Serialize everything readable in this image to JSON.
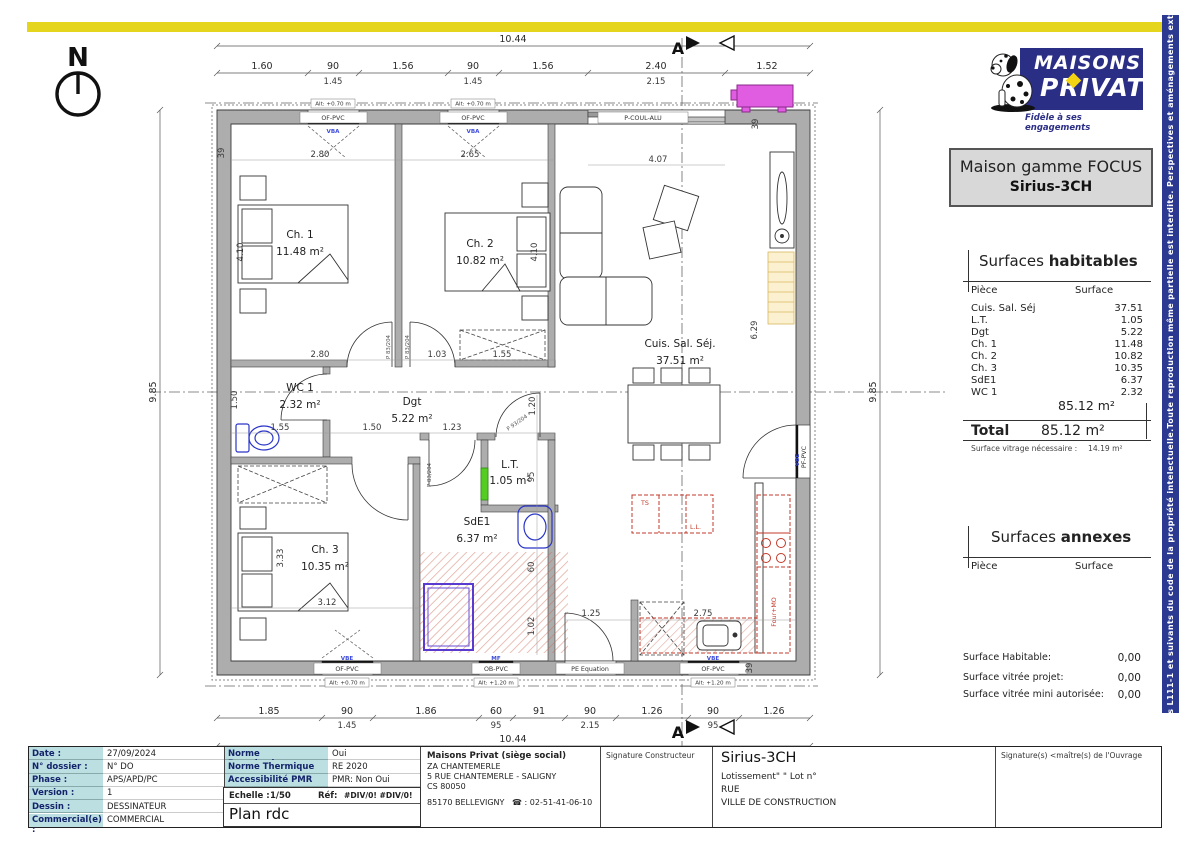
{
  "colors": {
    "brand_blue": "#2b2e85",
    "accent_yellow": "#e6d51d",
    "label_teal": "#bcdfe2",
    "wall_gray": "#adadad",
    "kitchen_red": "#c0392b",
    "pac_magenta": "#e05ce0",
    "sanitary_blue": "#2a35c8",
    "shower_purple": "#5a3bd0",
    "heater_green": "#55cc22"
  },
  "logo": {
    "line1": "MAISONS",
    "line2": "PRIVAT",
    "tagline": "Fidèle à ses engagements"
  },
  "model_box": {
    "line1": "Maison gamme FOCUS",
    "line2": "Sirius-3CH"
  },
  "surfaces_habitables": {
    "title_normal": "Surfaces ",
    "title_bold": "habitables",
    "col_piece": "Pièce",
    "col_surface": "Surface",
    "rows": [
      {
        "piece": "Cuis. Sal. Séj",
        "surface": "37.51"
      },
      {
        "piece": "L.T.",
        "surface": "1.05"
      },
      {
        "piece": "Dgt",
        "surface": "5.22"
      },
      {
        "piece": "Ch. 1",
        "surface": "11.48"
      },
      {
        "piece": "Ch. 2",
        "surface": "10.82"
      },
      {
        "piece": "Ch. 3",
        "surface": "10.35"
      },
      {
        "piece": "SdE1",
        "surface": "6.37"
      },
      {
        "piece": "WC 1",
        "surface": "2.32"
      }
    ],
    "subtotal": "85.12 m²",
    "total_label": "Total",
    "total_value": "85.12 m²",
    "note_label": "Surface vitrage nécessaire :",
    "note_value": "14.19 m²"
  },
  "surfaces_annexes": {
    "title_normal": "Surfaces ",
    "title_bold": "annexes",
    "col_piece": "Pièce",
    "col_surface": "Surface"
  },
  "summary": {
    "rows": [
      {
        "label": "Surface Habitable:",
        "value": "0,00"
      },
      {
        "label": "Surface vitrée projet:",
        "value": "0,00"
      },
      {
        "label": "Surface vitrée mini autorisée:",
        "value": "0,00"
      }
    ]
  },
  "side_strip": {
    "text": "Plans protégés par les articles L111-1 et suivants du code de la propriété intelectuelle.Toute reproduction même partielle est interdite. Perspectives et aménagements extérieurs sont non contractuels"
  },
  "title_block": {
    "info_rows": [
      {
        "label": "Date :",
        "value": "27/09/2024"
      },
      {
        "label": "N° dossier :",
        "value": "N° DO"
      },
      {
        "label": "Phase :",
        "value": "APS/APD/PC"
      },
      {
        "label": "Version :",
        "value": "1"
      },
      {
        "label": "Dessin :",
        "value": "DESSINATEUR"
      },
      {
        "label": "Commercial(e) :",
        "value": "COMMERCIAL"
      }
    ],
    "norm_rows": [
      {
        "label": "Norme Parasismique",
        "value": "Oui"
      },
      {
        "label": "Norme Thermique",
        "value": "RE 2020"
      },
      {
        "label": "Accessibilité PMR",
        "value": "PMR: Non Oui"
      }
    ],
    "echelle_label": "Echelle :",
    "echelle_value": "1/50",
    "ref_label": "Réf:",
    "ref_value": "#DIV/0! #DIV/0!",
    "plan_name": "Plan rdc",
    "company": {
      "name": "Maisons Privat (siège social)",
      "line1": "ZA CHANTEMERLE",
      "line2": "5 RUE CHANTEMERLE - SALIGNY",
      "line3": "CS 80050",
      "line4": "85170 BELLEVIGNY",
      "phone": "☎ : 02-51-41-06-10"
    },
    "sig_constructor": "Signature Constructeur",
    "project": {
      "name": "Sirius-3CH",
      "line1": "Lotissement\"  \" Lot n°",
      "line2": "RUE",
      "line3": "VILLE DE CONSTRUCTION"
    },
    "sig_owner": "Signature(s) <maître(s) de l'Ouvrage"
  },
  "plan": {
    "north_label": "N",
    "section_label": "A",
    "overall_width": "10.44",
    "overall_height": "9.85",
    "top_chain": [
      "1.60",
      "90",
      "1.56",
      "90",
      "1.56",
      "2.40",
      "1.52"
    ],
    "top_chain_sub": [
      "1.45",
      "1.45",
      "2.15"
    ],
    "bottom_chain": [
      "1.85",
      "90",
      "1.86",
      "60",
      "91",
      "90",
      "1.26",
      "90",
      "1.26"
    ],
    "bottom_chain_sub": [
      "1.45",
      "95",
      "2.15",
      "95"
    ],
    "rooms": [
      {
        "name": "Ch. 1",
        "area": "11.48 m²"
      },
      {
        "name": "Ch. 2",
        "area": "10.82 m²"
      },
      {
        "name": "Cuis. Sal. Séj.",
        "area": "37.51 m²"
      },
      {
        "name": "WC 1",
        "area": "2.32 m²"
      },
      {
        "name": "Dgt",
        "area": "5.22 m²"
      },
      {
        "name": "L.T.",
        "area": "1.05 m²"
      },
      {
        "name": "SdE1",
        "area": "6.37 m²"
      },
      {
        "name": "Ch. 3",
        "area": "10.35 m²"
      }
    ],
    "interior_dims": [
      "2.80",
      "2.65",
      "4.07",
      "2.80",
      "1.03",
      "1.55",
      "1.55",
      "1.50",
      "1.23",
      "3.12",
      "1.25",
      "2.75",
      "4.10",
      "4.10",
      "6.29",
      "1.50",
      "3.33",
      "95",
      "1.20",
      "60",
      "1.02",
      "39",
      "39",
      "39"
    ],
    "labels": {
      "of_pvc": "OF-PVC",
      "ob_pvc": "OB-PVC",
      "p_coul_alu": "P-COUL-ALU",
      "pe_equation": "PE Equation",
      "pf_pvc": "PF-PVC",
      "alt_070": "Alt: +0.70 m",
      "alt_120": "Alt: +1.20 m",
      "vba": "VBA",
      "vbe": "VBE",
      "mf": "MF",
      "p83": "P 83/204",
      "p93": "P 93/204",
      "ll": "L.L.",
      "four_mo": "Four+MO",
      "ts": "TS"
    }
  }
}
